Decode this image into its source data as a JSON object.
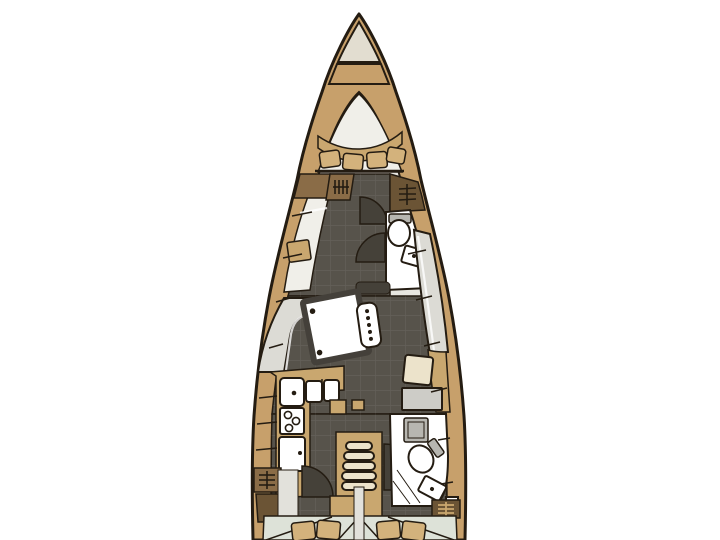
{
  "meta": {
    "description": "Top-view interior layout plan of a sailing yacht hull on a white background, bow at top, stern cut off at bottom edge"
  },
  "colors": {
    "background": "#ffffff",
    "outline": "#241c12",
    "hull_deck": "#c7a06b",
    "bow_cream": "#e2ddd0",
    "interior_light": "#e8e7e1",
    "berth_white": "#f0efe9",
    "floor_dark": "#57534b",
    "door_fan": "#454139",
    "table_border": "#44403a",
    "wood_tan": "#c9a76f",
    "wood_brown": "#8a6c47",
    "wood_dark_brown": "#6b5435",
    "cream": "#ece3cb",
    "white": "#ffffff",
    "gray_light": "#dcdbd5",
    "gray_mid": "#b7b6b0",
    "chart_gray": "#cdccc7",
    "aft_berth": "#dde2d8",
    "pillow_tan": "#d3b27c",
    "strip_light": "#e2e1db"
  },
  "features": [
    {
      "id": "bow-anchor-locker",
      "label": "Bow anchor locker"
    },
    {
      "id": "v-berth",
      "label": "Forward V-berth with curved headboard band and pillows"
    },
    {
      "id": "forward-cabin",
      "label": "Forward cabin with port berth and lockers"
    },
    {
      "id": "forward-head",
      "label": "Forward head with toilet and corner sink"
    },
    {
      "id": "saloon",
      "label": "Saloon with port L-settee, table and starboard bench"
    },
    {
      "id": "mast-post",
      "label": "Mast compression post with bolt dots"
    },
    {
      "id": "galley",
      "label": "Port L-shaped galley with sinks, 3-burner stove and fridge"
    },
    {
      "id": "nav-station",
      "label": "Starboard navigation station with seat and chart table"
    },
    {
      "id": "aft-head",
      "label": "Starboard aft head with sink, toilet and shower"
    },
    {
      "id": "companionway",
      "label": "Companionway steps amidships"
    },
    {
      "id": "aft-cabins",
      "label": "Twin aft double berths with pillows (cut off at image bottom)"
    },
    {
      "id": "hanging-lockers",
      "label": "Hanging lockers marked with hanger icons"
    },
    {
      "id": "door-arcs",
      "label": "Door swing arcs in cabin sole"
    }
  ],
  "counts": {
    "bow_pillows": 4,
    "aft_pillows": 4,
    "companionway_steps": 5,
    "stove_burners": 3,
    "mast_post_dots": 5,
    "table_corner_dots": 2,
    "hanger_icons": 3
  }
}
